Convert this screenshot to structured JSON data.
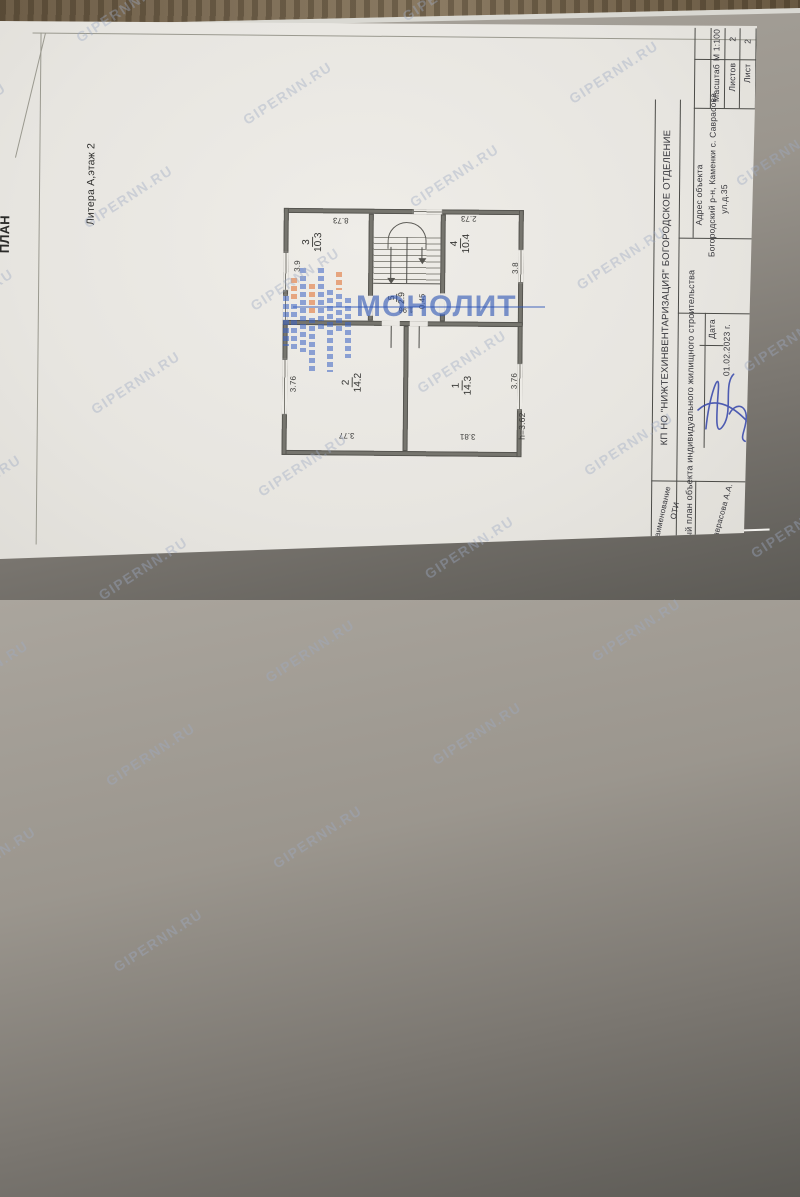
{
  "page": {
    "litera": "Литера А,этаж 2",
    "clipped_left_title": "ПЛАН"
  },
  "watermark": {
    "text": "GIPERNN.RU"
  },
  "brand": {
    "name": "МОНОЛИТ"
  },
  "titleblock": {
    "org": "КП НО \"НИЖТЕХИНВЕНТАРИЗАЦИЯ\" БОГОРОДСКОЕ ОТДЕЛЕНИЕ",
    "doc_type": "Поэтажный план объекта индивидуального жилищного строительства",
    "address_label": "Адрес объекта",
    "address_line1": "Богородский р-н, Каменки с. Саврасова",
    "address_line2": "ул.д.35",
    "date_label": "Дата",
    "date_value": "01.02.2023 г.",
    "name_header_line1": "Наименование",
    "name_header_line2": "ОТИ",
    "executor": "Саврасова А.А.",
    "sheet_label": "Лист",
    "sheet_value": "2",
    "sheets_label": "Листов",
    "sheets_value": "2",
    "scale_label": "Масштаб",
    "scale_value": "М 1:100"
  },
  "plan": {
    "rooms": [
      {
        "num": "1",
        "area": "14.3"
      },
      {
        "num": "2",
        "area": "14.2"
      },
      {
        "num": "3",
        "area": "10.3"
      },
      {
        "num": "4",
        "area": "10.4"
      },
      {
        "num": "5",
        "area": "2.9"
      }
    ],
    "dims": {
      "overall_top": "8.73",
      "room4_top": "2.73",
      "room3_side": "3.9",
      "room4_side": "3.8",
      "room5_width": "1.96",
      "room5_note": "0.45",
      "room2_side": "3.76",
      "room2_bottom": "3.77",
      "room1_bottom": "3.81",
      "room1_side": "3.76",
      "height_note": "h=3.62"
    }
  }
}
